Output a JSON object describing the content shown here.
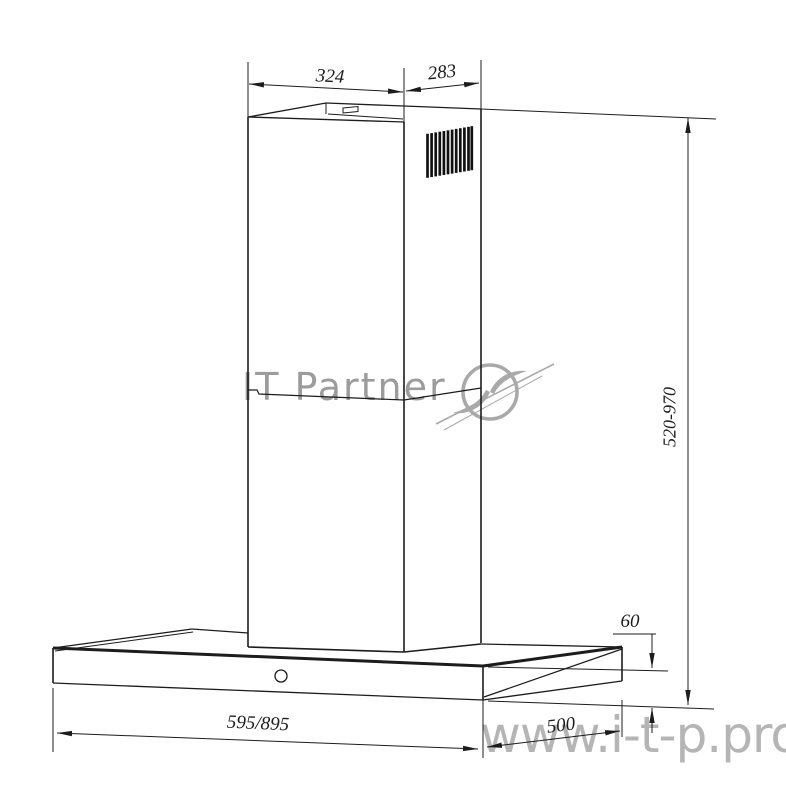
{
  "drawing": {
    "subject": "chimney-cooker-hood-dimension-drawing",
    "line_color": "#1c1c1c",
    "background_color": "#ffffff",
    "watermark_color": "#9c9c9c"
  },
  "dimensions": {
    "top_width": "324",
    "top_depth": "283",
    "height_range": "520-970",
    "base_height": "60",
    "base_depth": "500",
    "base_width": "595/895"
  },
  "watermarks": {
    "brand": "IT Partner",
    "site": "www.i-t-p.pro"
  }
}
